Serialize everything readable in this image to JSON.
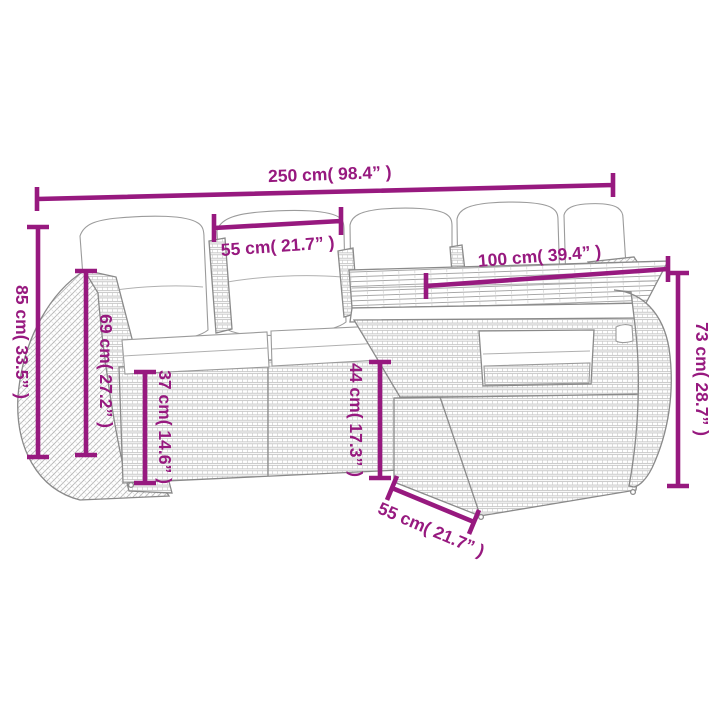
{
  "diagram": {
    "subject": "rattan garden sofa set with table, line drawing with dimension annotations",
    "background": "#ffffff",
    "accent_color": "#97197f",
    "lineart_color": "#8a8a8a"
  },
  "labels": {
    "total_width": "250 cm( 98.4” )",
    "cushion_width": "55 cm( 21.7” )",
    "table_length": "100 cm( 39.4” )",
    "total_height": "85 cm( 33.5” )",
    "back_height": "69 cm( 27.2” )",
    "seat_height": "37 cm( 14.6” )",
    "under_table_height": "44 cm( 17.3” )",
    "table_height": "73 cm( 28.7” )",
    "table_depth": "55 cm( 21.7” )"
  }
}
